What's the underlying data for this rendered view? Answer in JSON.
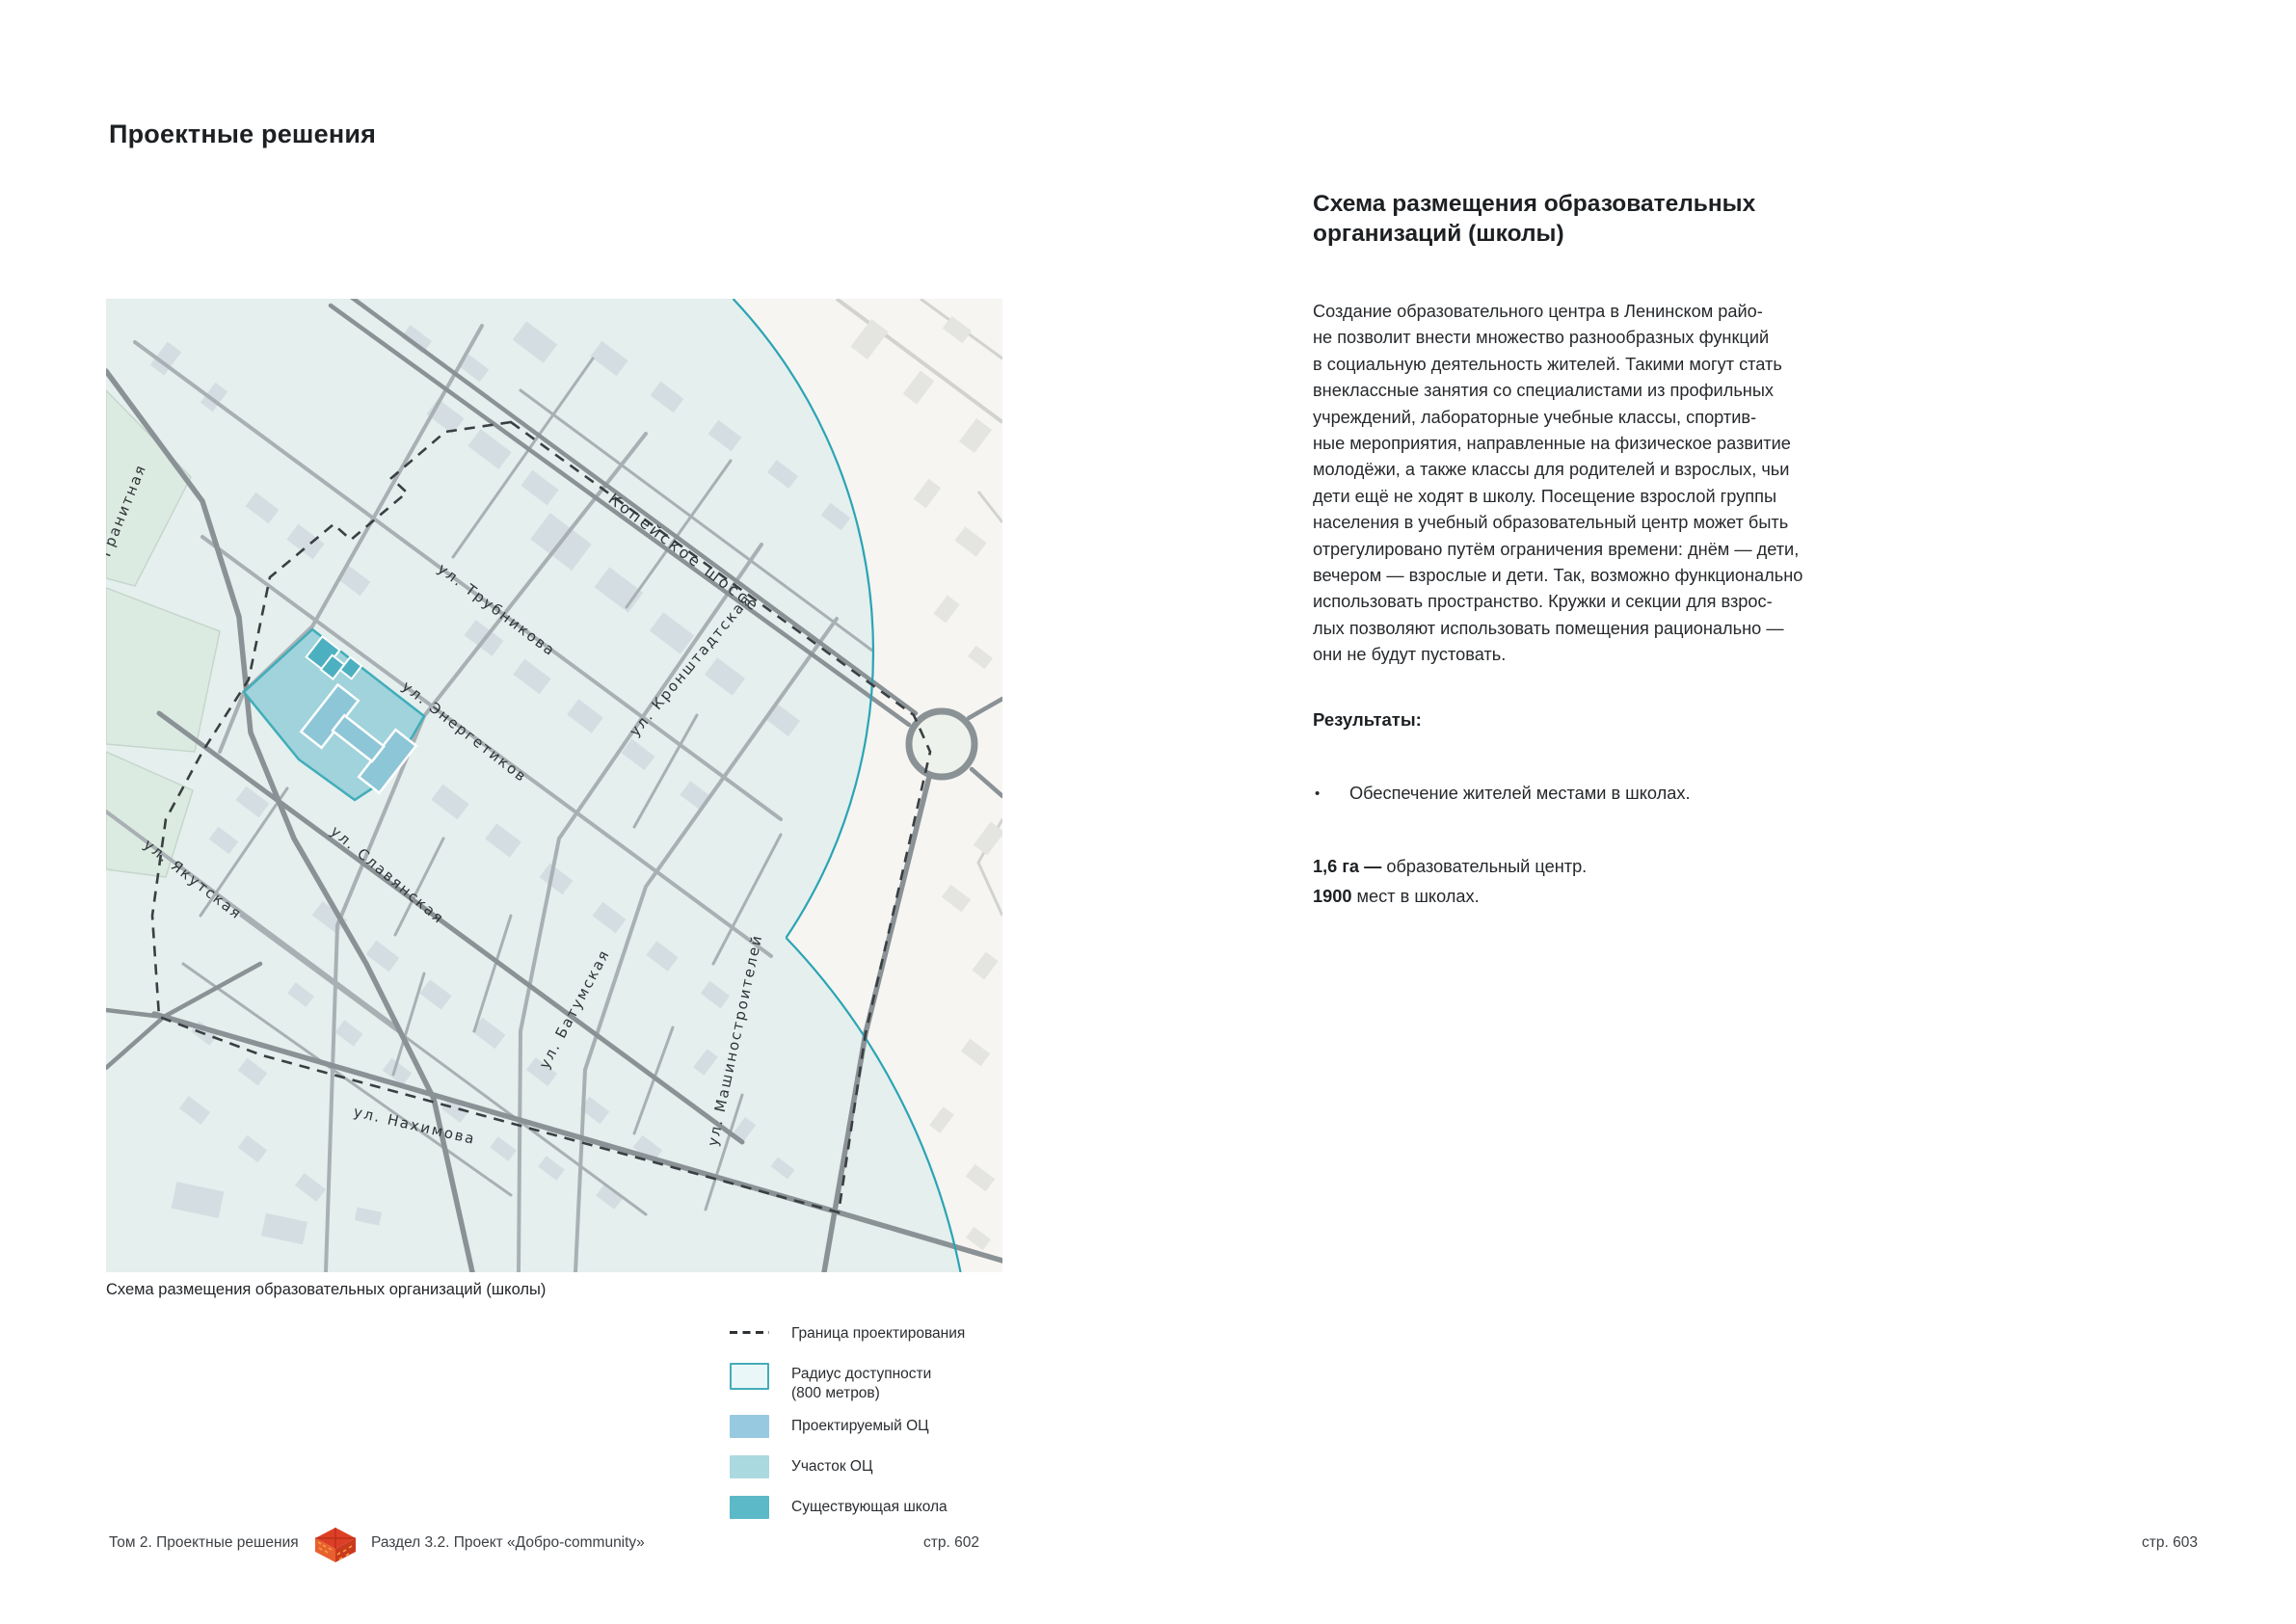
{
  "page": {
    "title": "Проектные решения"
  },
  "map": {
    "caption": "Схема размещения образовательных организаций (школы)",
    "streets": [
      {
        "name": "Копейское  шоссе"
      },
      {
        "name": "ул.  Трубникова"
      },
      {
        "name": "ул. Энергетиков"
      },
      {
        "name": "ул. Кронштадтская"
      },
      {
        "name": "ул. Гранитная"
      },
      {
        "name": "ул. Якутская"
      },
      {
        "name": "ул.  Славянская"
      },
      {
        "name": "ул. Батумская"
      },
      {
        "name": "ул. Нахимова"
      },
      {
        "name": "ул. Машиностроителей"
      }
    ],
    "colors": {
      "radius_fill": "#e4efee",
      "radius_stroke": "#2ba4b4",
      "site_fill": "#a0d3db",
      "site_stroke": "#41adb9",
      "oc_building": "#8dc6d6",
      "school_building": "#4db0c0",
      "boundary_dash": "#3a3f42"
    }
  },
  "legend": {
    "items": [
      {
        "label": "Граница проектирования"
      },
      {
        "label": "Радиус доступности\n(800 метров)"
      },
      {
        "label": "Проектируемый ОЦ"
      },
      {
        "label": "Участок ОЦ"
      },
      {
        "label": "Существующая школа"
      }
    ],
    "swatches": {
      "radius_fill": "#eaf7f8",
      "radius_border": "#45abb8",
      "planned_oc": "#97c9e1",
      "site_oc": "#abd9e0",
      "existing_school": "#5cb9c7"
    }
  },
  "article": {
    "heading": "Схема размещения образовательных\nорганизаций (школы)",
    "body": "Создание образовательного центра в Ленинском райо-\nне позволит внести множество разнообразных функций\nв социальную деятельность жителей. Такими могут стать\nвнеклассные занятия со специалистами из профильных\nучреждений, лабораторные учебные классы, спортив-\nные мероприятия, направленные на физическое развитие\nмолодёжи, а также классы для родителей и взрослых, чьи\nдети ещё не ходят в школу. Посещение взрослой группы\nнаселения в учебный образовательный центр может быть\nотрегулировано путём ограничения времени: днём — дети,\nвечером — взрослые и дети. Так, возможно функционально\nиспользовать пространство. Кружки и секции для взрос-\nлых позволяют использовать помещения рационально —\nони не будут пустовать.",
    "results_heading": "Результаты:",
    "bullet": "Обеспечение жителей местами в школах.",
    "stats": [
      {
        "bold": "1,6 га —",
        "rest": " образовательный центр."
      },
      {
        "bold": "1900",
        "rest": " мест в школах."
      }
    ]
  },
  "footer": {
    "left": "Том 2. Проектные решения",
    "section": "Раздел 3.2. Проект «Добро-community»",
    "page_left": "стр. 602",
    "page_right": "стр. 603"
  }
}
